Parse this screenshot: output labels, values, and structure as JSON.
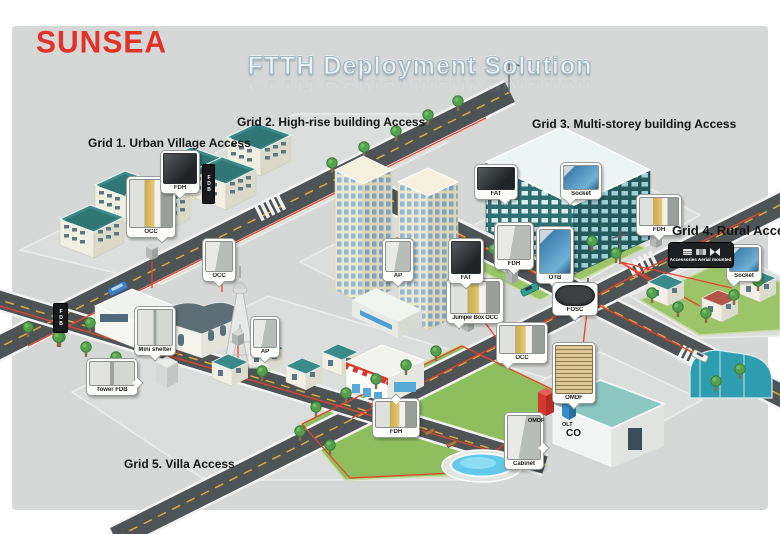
{
  "logo": {
    "text": "SUNSEA",
    "color": "#e23127"
  },
  "title": {
    "text": "FTTH Deployment Solution"
  },
  "grid_labels": {
    "grid1": "Grid 1. Urban Village Access",
    "grid2": "Grid 2. High-rise building Access",
    "grid3": "Grid 3. Multi-storey building Access",
    "grid4": "Grid 4. Rural Access",
    "grid5": "Grid 5. Villa Access"
  },
  "callouts": {
    "g1_occ": "OCC",
    "g1_fdh": "FDH",
    "street_occ": "OCC",
    "mini_shelter": "Mini shelter",
    "tower_fdb": "Tower FDB",
    "villa_ap": "AP",
    "villa_fdh": "FDH",
    "jumper_occ": "Jumper Box OCC",
    "center_occ": "OCC",
    "highrise_ap": "AP",
    "highrise_fat": "FAT",
    "ms_fat": "FAT",
    "ms_socket": "Socket",
    "ms_fdh": "FDH",
    "ms_otb": "OTB",
    "fosc": "FOSC",
    "rural_fdh": "FDH",
    "rural_socket": "Socket",
    "co_omdf": "OMDF",
    "cabinet": "Cabinet"
  },
  "equipment_labels": {
    "omdf": "OMDF",
    "olt": "OLT",
    "co": "CO",
    "wall_fdb": "FDB",
    "aerial_accessories": "Accessories Aerial mounted"
  },
  "colors": {
    "brand_red": "#e23127",
    "fiber_line": "#e8432e",
    "road": "#4e5356",
    "lawn": "#8fbe5e",
    "teal_roof": "#3a8a87",
    "panel_bg": "#d6d8d7"
  }
}
